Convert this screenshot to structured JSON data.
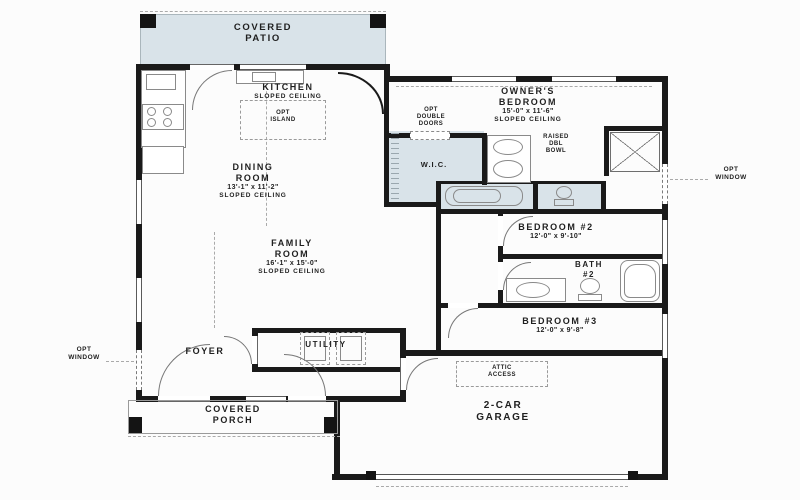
{
  "colors": {
    "wall": "#1a1a1a",
    "shade": "#d9e3e9",
    "paper": "#fcfcfc",
    "text": "#1f1f1f"
  },
  "rooms": {
    "covered_patio": {
      "name": "COVERED PATIO"
    },
    "kitchen": {
      "name": "KITCHEN",
      "note": "SLOPED CEILING"
    },
    "dining_room": {
      "name": "DINING ROOM",
      "dims": "13'-1\" x 11'-2\"",
      "note": "SLOPED CEILING"
    },
    "family_room": {
      "name": "FAMILY ROOM",
      "dims": "16'-1\" x 15'-0\"",
      "note": "SLOPED CEILING"
    },
    "owners_bedroom": {
      "name": "OWNER'S BEDROOM",
      "dims": "15'-0\" x 11'-6\"",
      "note": "SLOPED CEILING"
    },
    "wic": {
      "name": "W.I.C."
    },
    "bedroom_2": {
      "name": "BEDROOM #2",
      "dims": "12'-0\" x 9'-10\""
    },
    "bath_2": {
      "name": "BATH",
      "number": "#2"
    },
    "bedroom_3": {
      "name": "BEDROOM #3",
      "dims": "12'-0\" x 9'-8\""
    },
    "foyer": {
      "name": "FOYER"
    },
    "utility": {
      "name": "UTILITY"
    },
    "covered_porch": {
      "name": "COVERED PORCH"
    },
    "garage": {
      "name": "2-CAR GARAGE"
    }
  },
  "annotations": {
    "opt_island": "OPT ISLAND",
    "opt_double_doors": "OPT DOUBLE DOORS",
    "raised_dbl_bowl": "RAISED DBL BOWL",
    "attic_access": "ATTIC ACCESS",
    "opt_window_left": "OPT WINDOW",
    "opt_window_right": "OPT WINDOW"
  }
}
